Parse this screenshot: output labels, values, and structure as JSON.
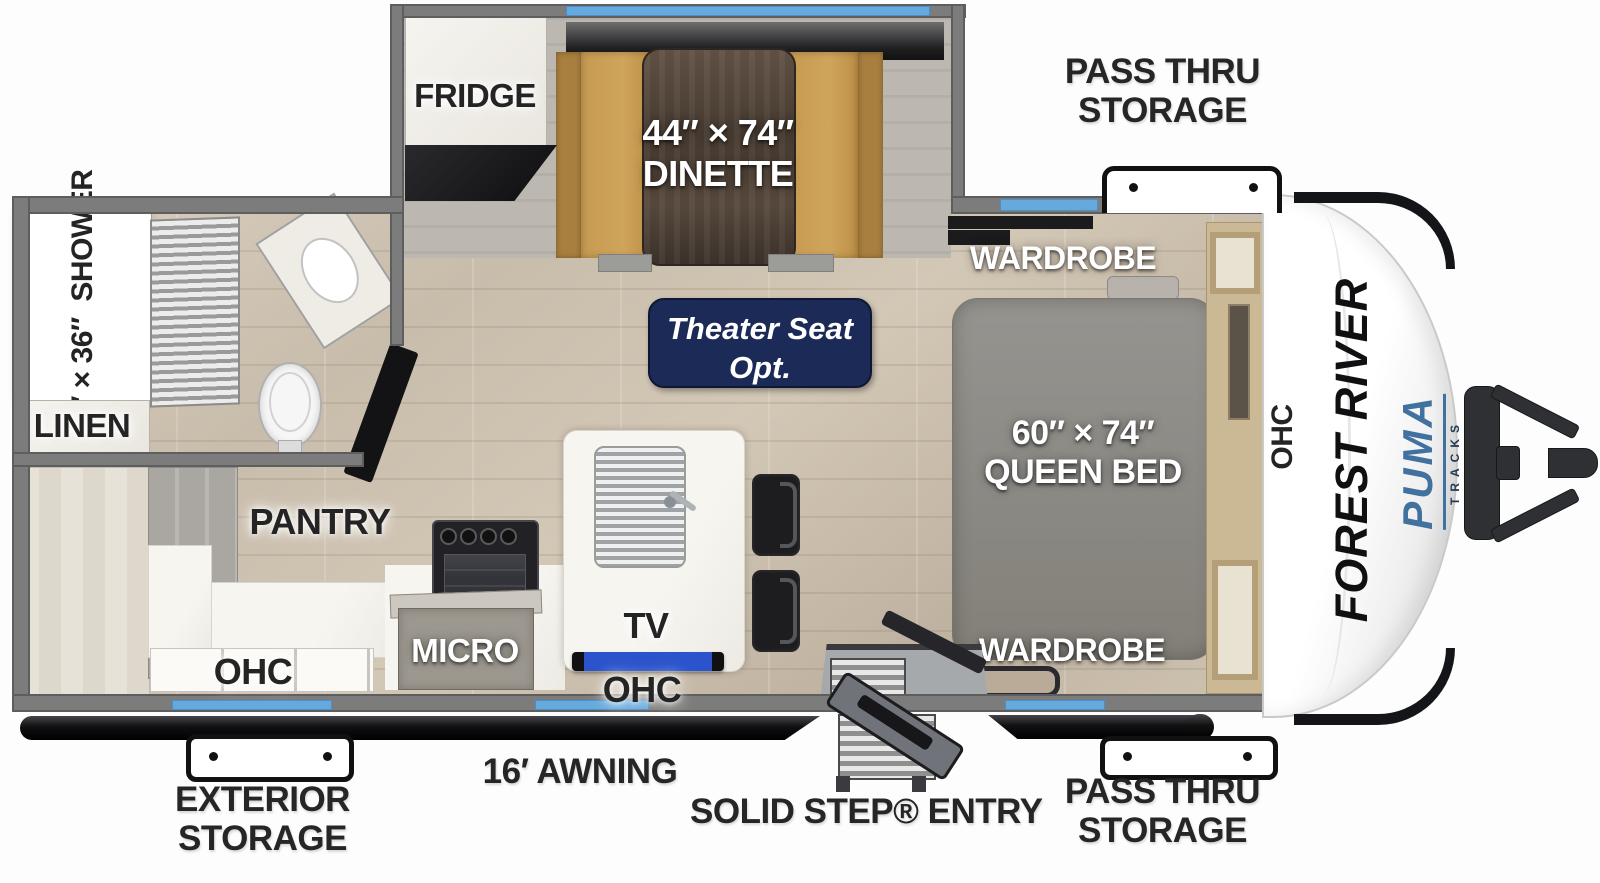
{
  "colors": {
    "accent_blue": "#66a9dd",
    "badge_navy": "#1c2a57",
    "brand_blue": "#41729f",
    "wall_gray": "#7c7c7c",
    "awning_black": "#111111"
  },
  "slideout": {
    "fridge_label": "FRIDGE",
    "dinette_size": "44″ × 74″",
    "dinette_label": "DINETTE"
  },
  "bathroom": {
    "shower_size": "24″ × 36″",
    "shower_label": "SHOWER",
    "linen_label": "LINEN"
  },
  "kitchen": {
    "pantry_label": "PANTRY",
    "micro_label": "MICRO",
    "tv_label": "TV",
    "ohc_label": "OHC"
  },
  "living": {
    "theater_line1": "Theater Seat",
    "theater_line2": "Opt."
  },
  "bedroom": {
    "wardrobe_label": "WARDROBE",
    "bed_size": "60″ × 74″",
    "bed_label": "QUEEN BED",
    "ohc_front_label": "OHC"
  },
  "exterior": {
    "pass_thru_label": "PASS THRU STORAGE",
    "exterior_storage_label": "EXTERIOR STORAGE",
    "awning_label": "16′ AWNING",
    "entry_label": "SOLID STEP® ENTRY"
  },
  "brand": {
    "manufacturer": "FOREST RIVER",
    "model": "PUMA",
    "series": "TRACKS"
  }
}
